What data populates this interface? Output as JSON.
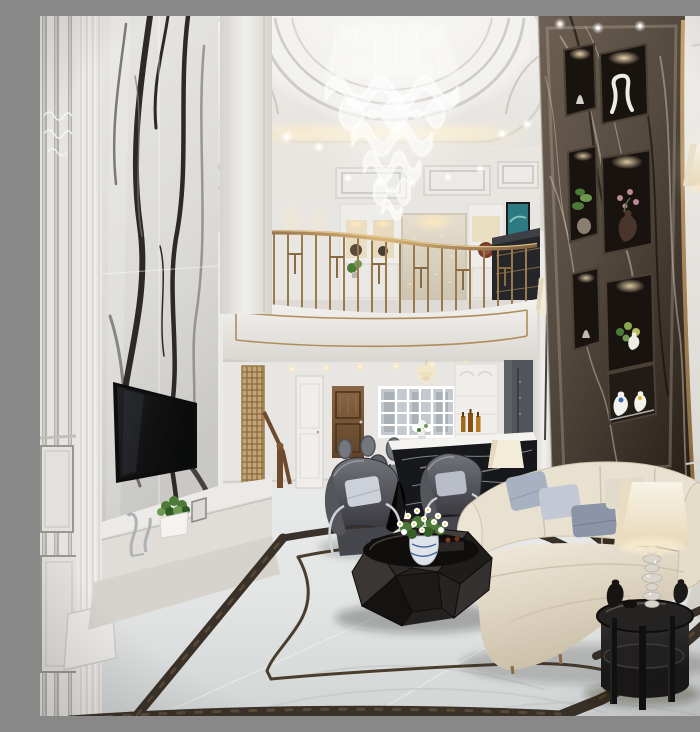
{
  "scene": {
    "title": "Luxury two-storey living room",
    "description": "Photorealistic render of a luxury duplex living room: tiered wavy crystal chandelier under a scalloped white dome ceiling with warm cove lighting, white panda-marble feature pillar with wall-mounted TV, curved mezzanine balcony with brass geometric railing, dark emperador marble feature wall with lit display niches and vases, chrome wall sconce, cream sofa with blue-gray pillows, two dark leather armchairs, faceted black coffee table with white daisies in a porcelain vase, black oval side table with crystal table lamp, dining nook and bar in the background, and a polished white marble floor with dark marble inlay borders."
  },
  "palette": {
    "ceilingWhite": "#f2f1ee",
    "ceilingShade": "#ddd9d3",
    "coveGlow": "#f7ecd2",
    "wallWhite": "#eceae6",
    "wallShade": "#d6d3cd",
    "marbleLight": "#e7e6e3",
    "marbleVein": "#2d2926",
    "pilasterWhite": "#f1f0ed",
    "brass": "#b08c5a",
    "brassDeep": "#7d5f3a",
    "darkMarble": "#544a3f",
    "darkMarbleDeep": "#281f18",
    "darkMarbleVein": "#cfc2ad",
    "nicheDark": "#191310",
    "floorLight": "#eaeceb",
    "floorShade": "#d2d5d5",
    "inlayBrown": "#3a3128",
    "sofaCream": "#ece4d3",
    "sofaShade": "#c9bda6",
    "pillowBlue": "#a7b1c2",
    "pillowSlate": "#8b95a7",
    "chairGray": "#63646b",
    "chairDeep": "#36363c",
    "furnitureBlack": "#1c1b1a",
    "lampCream": "#f3ecd9",
    "woodBrown": "#82603f",
    "goldScreen": "#c3a476",
    "leafGreen": "#4d7a37",
    "glassBlue": "#c3c9ce",
    "tvBlack": "#121212",
    "tealArt": "#2c7b82"
  },
  "objects": [
    {
      "name": "ceiling-dome",
      "label": "scalloped dome ceiling with cove lighting"
    },
    {
      "name": "crystal-chandelier",
      "label": "tiered wavy crystal chandelier"
    },
    {
      "name": "mirror-trim-wall",
      "label": "white panelled wall with mirror strips"
    },
    {
      "name": "white-marble-feature-wall",
      "label": "panda white marble pillar"
    },
    {
      "name": "television",
      "label": "wall mounted flat TV"
    },
    {
      "name": "tv-console-ledge",
      "label": "marble TV ledge with plant and figurines"
    },
    {
      "name": "balcony-parapet",
      "label": "curved white parapet with brass trim"
    },
    {
      "name": "brass-railing",
      "label": "geometric brass balustrade"
    },
    {
      "name": "mezzanine-gallery",
      "label": "upper floor with shelving, wallpaper panel, console and art"
    },
    {
      "name": "staircase-screen",
      "label": "gold fretwork stair screen and wooden handrail"
    },
    {
      "name": "interior-door-wood",
      "label": "panelled timber door"
    },
    {
      "name": "french-window",
      "label": "white french window wall"
    },
    {
      "name": "bar-counter",
      "label": "black marble bar counter with bottle shelving"
    },
    {
      "name": "dining-set",
      "label": "grey oval-back dining chairs and table"
    },
    {
      "name": "dark-marble-feature-wall",
      "label": "emperador marble wall with lit niches and vases"
    },
    {
      "name": "wall-sconce",
      "label": "chrome wall sconce with cream shade"
    },
    {
      "name": "sofa",
      "label": "cream three-seat sofa with pillows"
    },
    {
      "name": "armchairs",
      "label": "two dark leather armchairs"
    },
    {
      "name": "coffee-table",
      "label": "faceted black coffee table with daisies"
    },
    {
      "name": "side-table",
      "label": "black oval side table with crystal lamp"
    },
    {
      "name": "floor-lamp",
      "label": "tall corner floor lamp"
    },
    {
      "name": "marble-floor",
      "label": "white marble floor with dark inlay border"
    }
  ]
}
